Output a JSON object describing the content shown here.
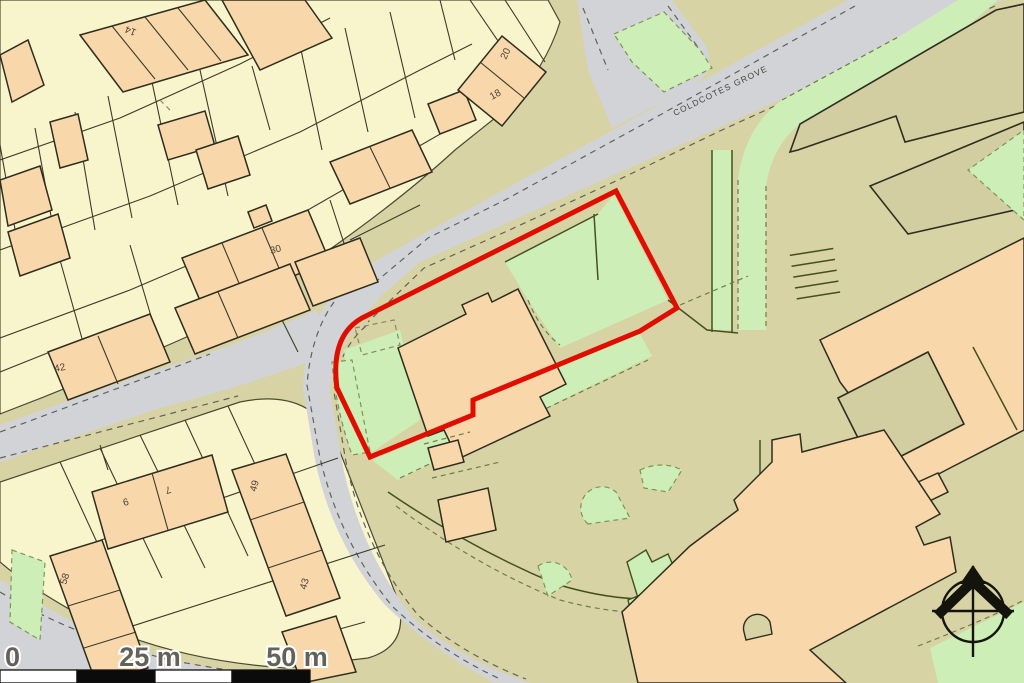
{
  "map": {
    "street_label": "COLDCOTES GROVE",
    "house_numbers": [
      {
        "text": "14"
      },
      {
        "text": "20"
      },
      {
        "text": "18"
      },
      {
        "text": "30"
      },
      {
        "text": "42"
      },
      {
        "text": "6"
      },
      {
        "text": "7"
      },
      {
        "text": "49"
      },
      {
        "text": "58"
      },
      {
        "text": "43"
      },
      {
        "text": "41"
      }
    ],
    "scale_bar": {
      "start_label": "0",
      "mid_label": "25 m",
      "end_label": "50 m"
    },
    "colors": {
      "site_boundary_red": "#e00e00",
      "road_gray": "#d2d3d7",
      "parcel_yellow": "#f8f5cd",
      "building_peach": "#f8d7ab",
      "grass_green": "#cdeeb7",
      "ground_olive": "#d7d3a5"
    }
  }
}
